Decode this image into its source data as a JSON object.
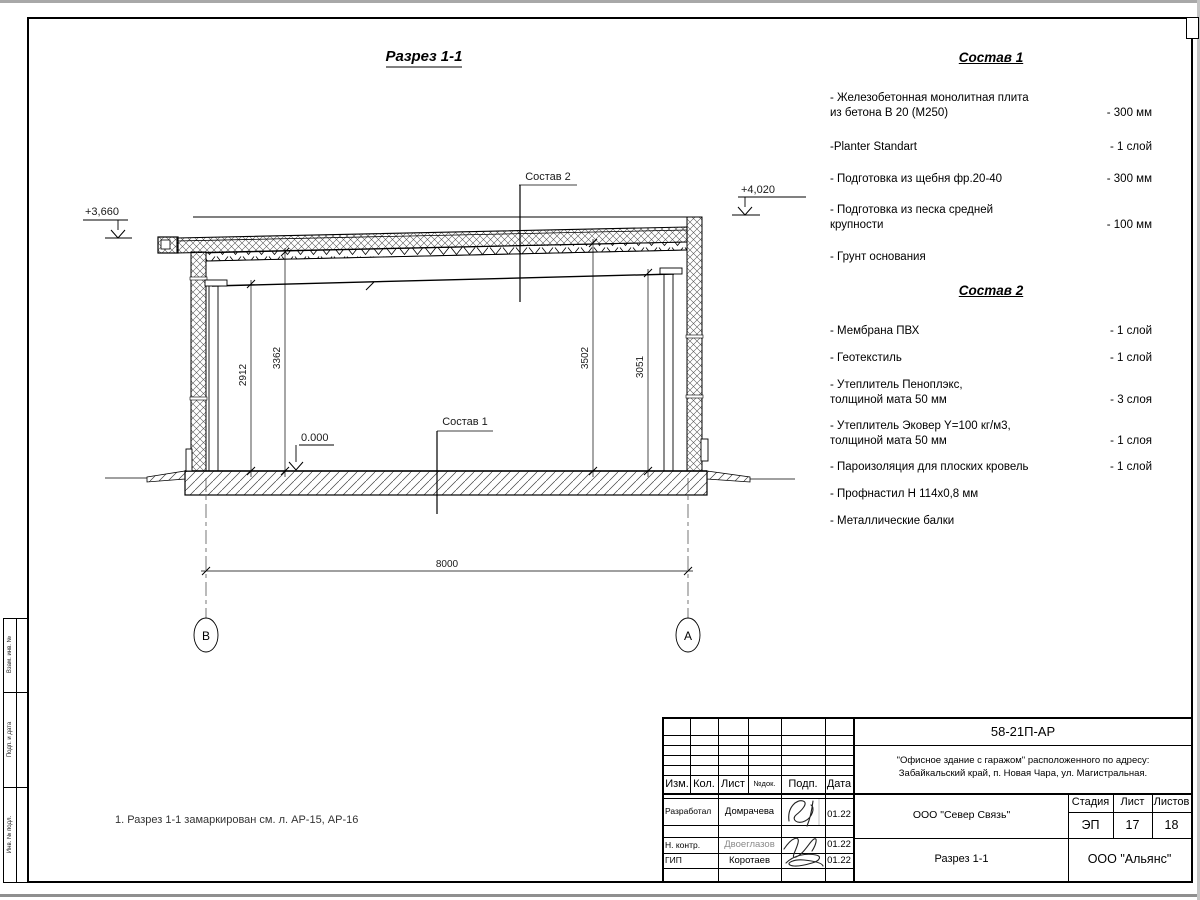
{
  "drawing": {
    "title": "Разрез 1-1",
    "label_sostav1": "Состав 1",
    "label_sostav2": "Состав 2",
    "elev_left": "+3,660",
    "elev_right": "+4,020",
    "elev_floor": "0.000",
    "dim_left_inner": "2912",
    "dim_left_outer": "3362",
    "dim_right_outer": "3502",
    "dim_right_inner": "3051",
    "dim_span": "8000",
    "axis_left": "В",
    "axis_right": "А"
  },
  "panel1": {
    "title": "Состав 1",
    "items": [
      {
        "name": "- Железобетонная  монолитная плита\nиз бетона В 20 (М250)",
        "value": "- 300 мм"
      },
      {
        "name": "-Planter Standart",
        "value": "- 1 слой"
      },
      {
        "name": "- Подготовка из щебня фр.20-40",
        "value": "- 300 мм"
      },
      {
        "name": "- Подготовка из песка средней\nкрупности",
        "value": "- 100 мм"
      },
      {
        "name": "- Грунт основания",
        "value": ""
      }
    ]
  },
  "panel2": {
    "title": "Состав 2",
    "items": [
      {
        "name": "- Мембрана ПВХ",
        "value": "- 1 слой"
      },
      {
        "name": "- Геотекстиль",
        "value": "- 1 слой"
      },
      {
        "name": "- Утеплитель Пеноплэкс,\nтолщиной мата 50 мм",
        "value": "- 3  слоя"
      },
      {
        "name": "- Утеплитель Эковер Y=100 кг/м3,\nтолщиной мата 50 мм",
        "value": "- 1 слоя"
      },
      {
        "name": "- Пароизоляция для плоских кровель",
        "value": "- 1 слой"
      },
      {
        "name": "- Профнастил Н 114х0,8 мм",
        "value": ""
      },
      {
        "name": "- Металлические балки",
        "value": ""
      }
    ]
  },
  "note": "1. Разрез 1-1 замаркирован см. л. АР-15, АР-16",
  "titleblock": {
    "doc_number": "58-21П-АР",
    "project_line1": "\"Офисное здание с гаражом\" расположенного по адресу:",
    "project_line2": "Забайкальский край, п. Новая Чара, ул. Магистральная.",
    "org": "ООО \"Север Связь\"",
    "sheet_name": "Разрез 1-1",
    "company": "ООО \"Альянс\"",
    "headers": [
      "Изм.",
      "Кол.",
      "Лист",
      "№док.",
      "Подп.",
      "Дата"
    ],
    "stage_label": "Стадия",
    "list_label": "Лист",
    "listov_label": "Листов",
    "stage": "ЭП",
    "list": "17",
    "listov": "18",
    "rows": [
      {
        "role": "Разработал",
        "name": "Домрачева",
        "date": "01.22"
      },
      {
        "role": "Н. контр.",
        "name": "Двоеглазов",
        "date": "01.22"
      },
      {
        "role": "ГИП",
        "name": "Коротаев",
        "date": "01.22"
      }
    ]
  },
  "side_stamp": {
    "labels": [
      "Взам. инв. №",
      "Подп. и дата",
      "Инв. № подл."
    ]
  }
}
